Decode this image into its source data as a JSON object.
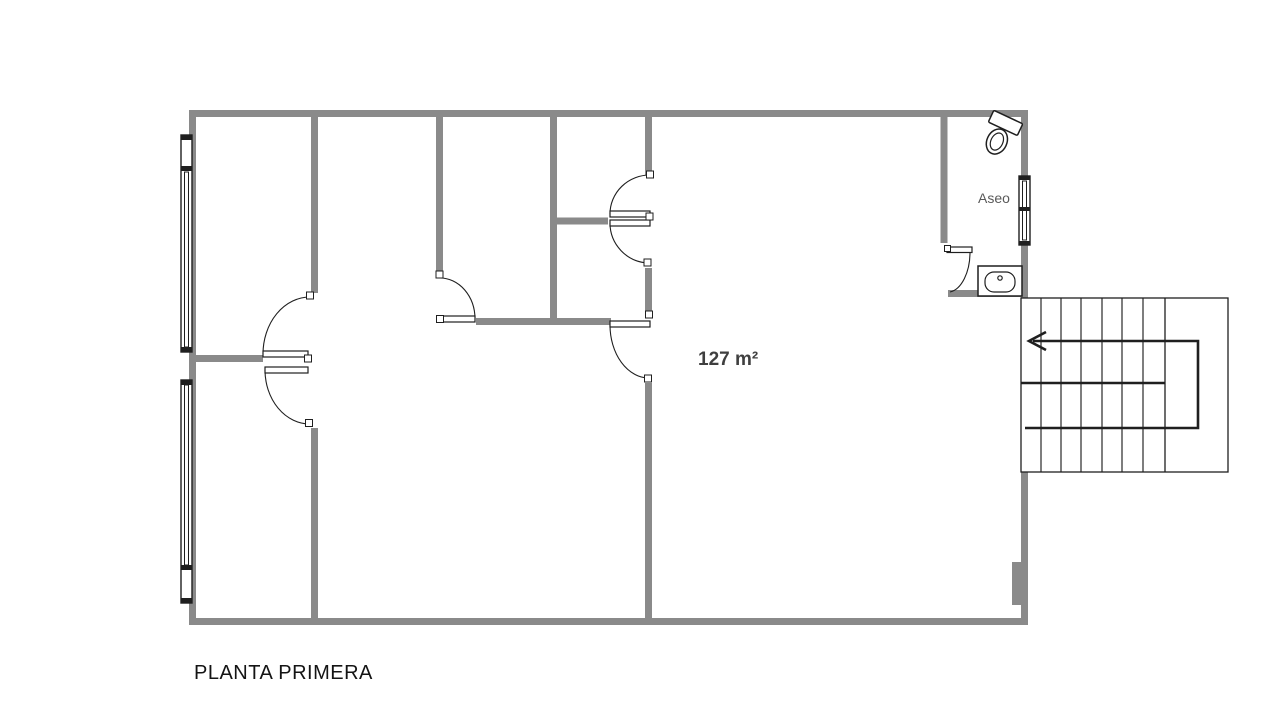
{
  "plan": {
    "title": "PLANTA PRIMERA",
    "area": "127 m²",
    "rooms": {
      "bathroom": "Aseo"
    },
    "colors": {
      "wall": "#8a8a8a",
      "outline": "#1f1f1f",
      "area_text": "#3f3f3f",
      "bathroom_text": "#595959",
      "title_text": "#141414",
      "background": "#ffffff"
    },
    "icons": {
      "toilet": "toilet-icon",
      "sink": "sink-icon",
      "stairs": "stairs-icon",
      "direction_arrow": "direction-arrow-icon",
      "window": "window-icon",
      "door": "door-swing-icon"
    }
  }
}
